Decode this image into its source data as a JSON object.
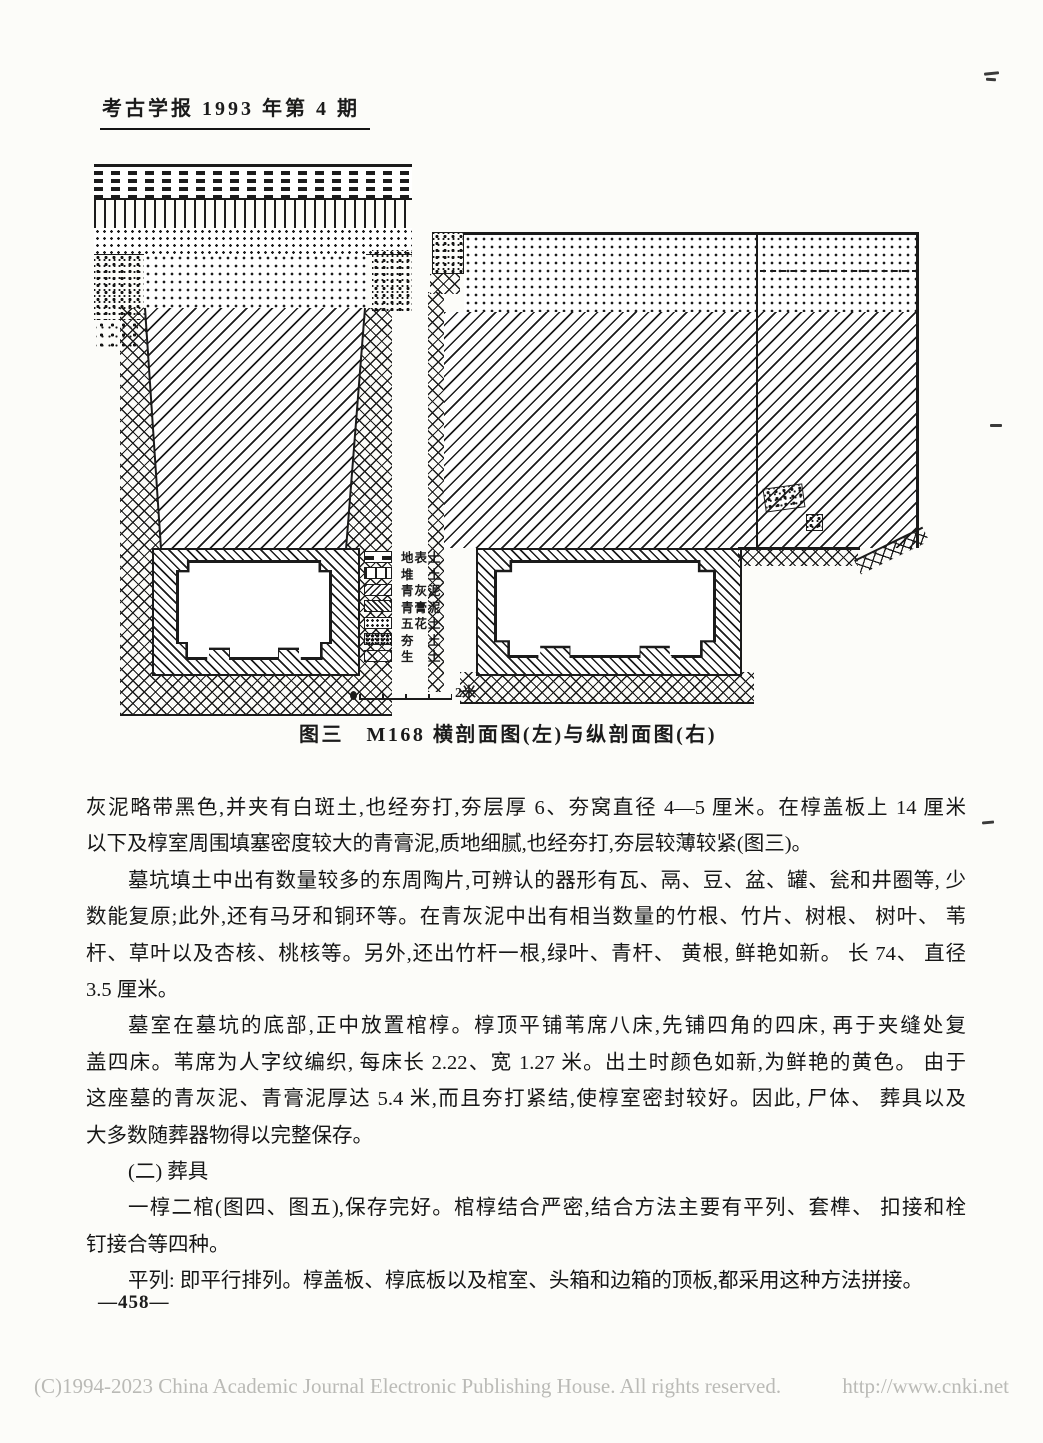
{
  "page": {
    "header": "考古学报 1993 年第 4 期",
    "page_number": "—458—",
    "footer_copyright": "(C)1994-2023 China Academic Journal Electronic Publishing House. All rights reserved.",
    "footer_url": "http://www.cnki.net",
    "ink_color": "#1b1b1b",
    "paper_color": "#fcfcf9",
    "footer_text_color": "#babab6"
  },
  "figure": {
    "caption": "图三　M168 横剖面图(左)与纵剖面图(右)",
    "scale_label": "2米",
    "legend": [
      {
        "label": "地表土",
        "pattern": "dash"
      },
      {
        "label": "堆　土",
        "pattern": "brick"
      },
      {
        "label": "青灰泥",
        "pattern": "hatch-forward"
      },
      {
        "label": "青膏泥",
        "pattern": "hatch-back"
      },
      {
        "label": "五花土",
        "pattern": "dots"
      },
      {
        "label": "夯　土",
        "pattern": "speckle"
      },
      {
        "label": "生　土",
        "pattern": "cross"
      }
    ]
  },
  "body": {
    "paragraphs": [
      {
        "lines": [
          "灰泥略带黑色,并夹有白斑土,也经夯打,夯层厚 6、夯窝直径 4—5 厘米。在椁盖板上 14 厘米",
          "以下及椁室周围填塞密度较大的青膏泥,质地细腻,也经夯打,夯层较薄较紧(图三)。"
        ]
      },
      {
        "lines": [
          "墓坑填土中出有数量较多的东周陶片,可辨认的器形有瓦、鬲、豆、盆、罐、瓮和井圈等, 少",
          "数能复原;此外,还有马牙和铜环等。在青灰泥中出有相当数量的竹根、竹片、树根、 树叶、 苇",
          "杆、草叶以及杏核、桃核等。另外,还出竹杆一根,绿叶、青杆、 黄根, 鲜艳如新。 长 74、 直径",
          "3.5 厘米。"
        ]
      },
      {
        "lines": [
          "墓室在墓坑的底部,正中放置棺椁。椁顶平铺苇席八床,先铺四角的四床, 再于夹缝处复",
          "盖四床。苇席为人字纹编织, 每床长 2.22、宽 1.27 米。出土时颜色如新,为鲜艳的黄色。 由于",
          "这座墓的青灰泥、青膏泥厚达 5.4 米,而且夯打紧结,使椁室密封较好。因此, 尸体、 葬具以及",
          "大多数随葬器物得以完整保存。"
        ]
      },
      {
        "lines": [
          "(二) 葬具"
        ]
      },
      {
        "lines": [
          "一椁二棺(图四、图五),保存完好。棺椁结合严密,结合方法主要有平列、套榫、 扣接和栓",
          "钉接合等四种。"
        ]
      },
      {
        "lines": [
          "平列: 即平行排列。椁盖板、椁底板以及棺室、头箱和边箱的顶板,都采用这种方法拼接。"
        ]
      }
    ]
  }
}
